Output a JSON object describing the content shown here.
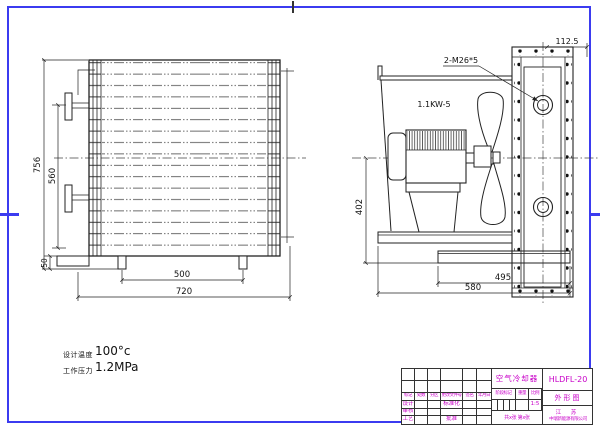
{
  "front_view": {
    "dims": {
      "overall_height": "756",
      "port_spacing": "560",
      "foot_height": "50",
      "feet_span": "500",
      "overall_width": "720"
    }
  },
  "side_view": {
    "dims": {
      "panel_depth": "112.5",
      "assembly_height": "402",
      "base_plate": "495",
      "overall_depth": "580"
    },
    "labels": {
      "ports": "2-M26*5",
      "motor": "1.1KW-5"
    }
  },
  "specs": {
    "design_temp_label": "设计温度",
    "design_temp_value": "100°c",
    "working_pressure_label": "工作压力",
    "working_pressure_value": "1.2MPa"
  },
  "title_block": {
    "product_name": "空气冷却器",
    "model": "HLDFL-20",
    "sheet_name": "外形图",
    "company_line1": "江 苏",
    "company_line2": "中瑞新能源有限公司",
    "rev_header": [
      "标记",
      "处数",
      "分区",
      "更改文件号",
      "签名",
      "年月日"
    ],
    "role_design": "设计",
    "role_standard": "标准化",
    "role_check": "审核",
    "role_process": "工艺",
    "role_approve": "批准",
    "stage_label": "阶段标记",
    "weight_label": "重量",
    "scale_label": "比例",
    "scale_value": "1:5",
    "sheet_info": "共x张 第x张"
  },
  "colors": {
    "frame_blue": "#3b3bf0",
    "title_magenta": "#c800c8",
    "line_black": "#222222"
  }
}
